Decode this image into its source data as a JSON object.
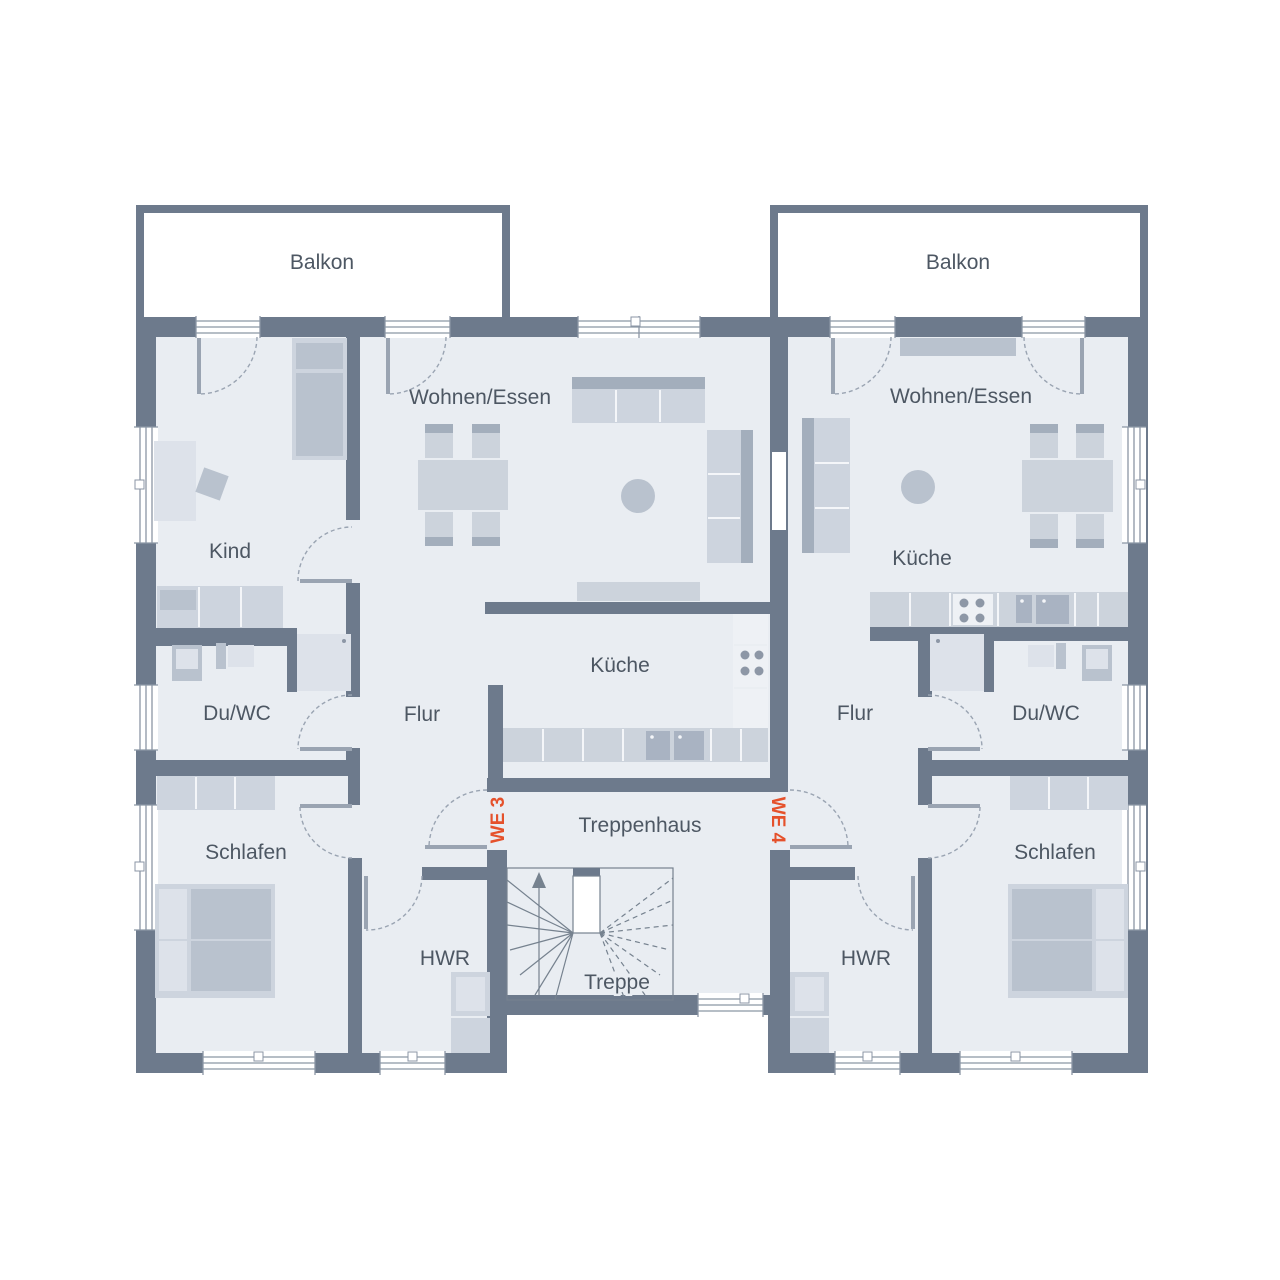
{
  "colors": {
    "wall": "#6d7a8c",
    "floor": "#e9edf2",
    "accent": "#e5512b",
    "label": "#4d5763",
    "window_frame": "#8b96a5",
    "door_arc": "#9aa4b2"
  },
  "units": {
    "left": "WE 3",
    "right": "WE 4"
  },
  "rooms": {
    "balkon_left": "Balkon",
    "balkon_right": "Balkon",
    "wohnen_left": "Wohnen/Essen",
    "wohnen_right": "Wohnen/Essen",
    "kind": "Kind",
    "kueche_left": "Küche",
    "kueche_right": "Küche",
    "duwc_left": "Du/WC",
    "duwc_right": "Du/WC",
    "flur_left": "Flur",
    "flur_right": "Flur",
    "schlafen_left": "Schlafen",
    "schlafen_right": "Schlafen",
    "hwr_left": "HWR",
    "hwr_right": "HWR",
    "treppenhaus": "Treppenhaus",
    "treppe": "Treppe"
  }
}
